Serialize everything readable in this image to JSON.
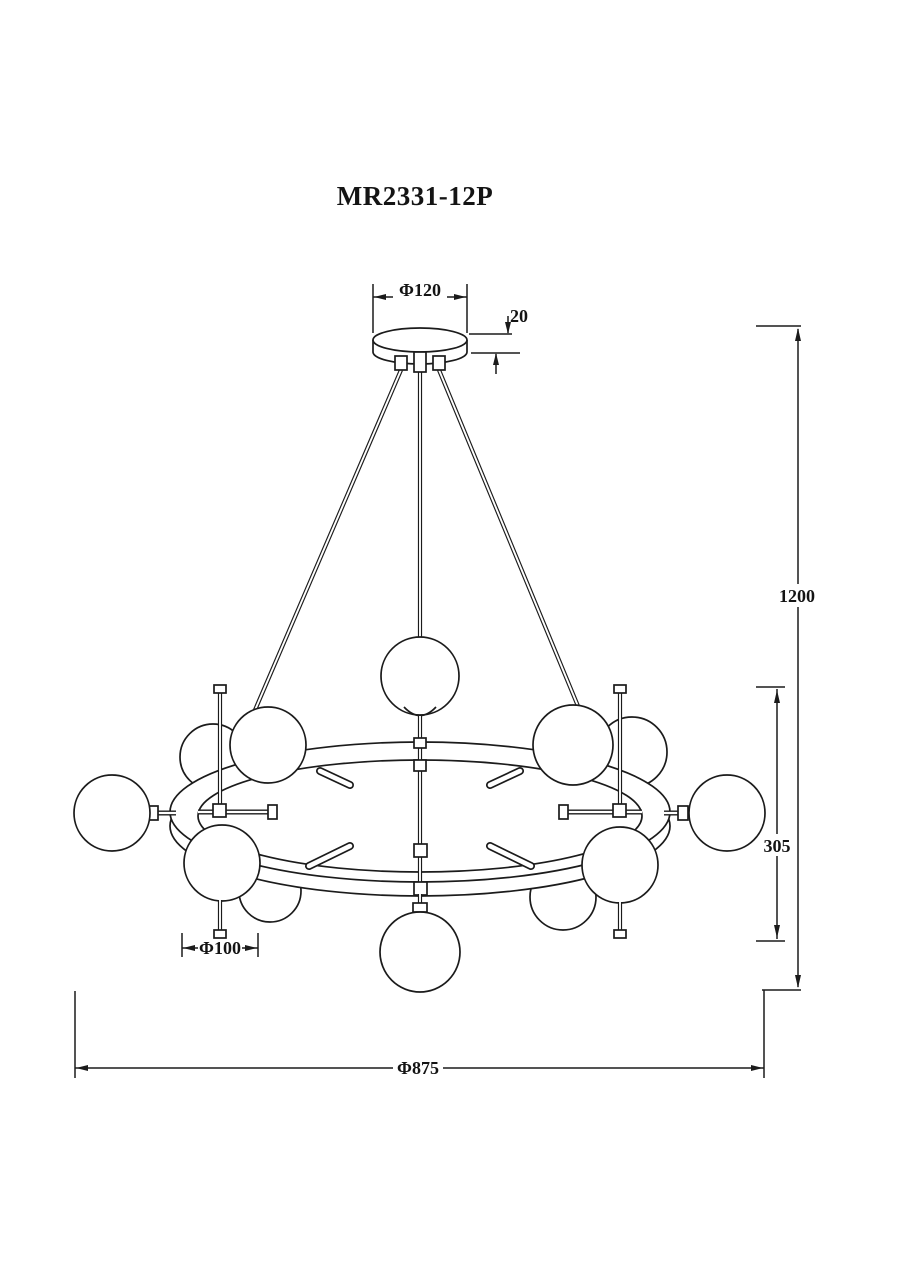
{
  "drawing": {
    "model": "MR2331-12P",
    "type": "chandelier dimensional drawing",
    "globe_count": 12,
    "colors": {
      "line": "#1b1b1b",
      "background": "#ffffff"
    },
    "dimensions": {
      "canopy_diameter": "Φ120",
      "canopy_height": "20",
      "suspension_height": "1200",
      "body_height": "305",
      "globe_diameter": "Φ100",
      "overall_diameter": "Φ875"
    }
  }
}
